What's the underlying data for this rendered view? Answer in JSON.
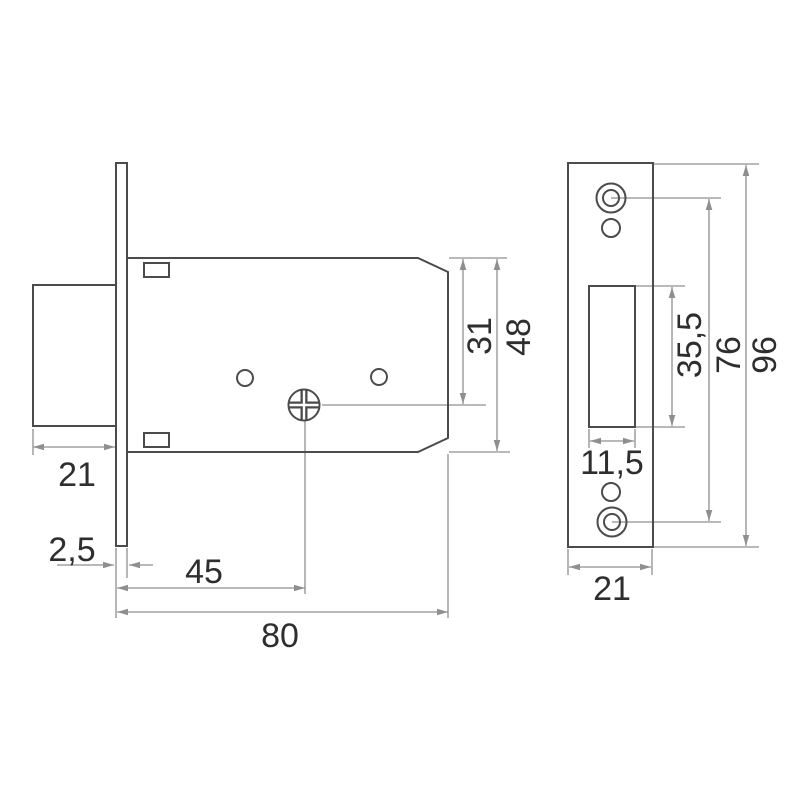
{
  "colors": {
    "outline": "#4b4b4b",
    "dimension": "#8f8f8f",
    "text": "#2e2e2e",
    "background": "#ffffff"
  },
  "drawing_type": "mortise-lock-technical-drawing",
  "views": {
    "lock_body": {
      "label": "lock body front view",
      "dims": {
        "bolt_width": "21",
        "faceplate_thickness": "2,5",
        "backset": "45",
        "case_depth": "80",
        "top_to_spindle": "31",
        "case_height": "48"
      }
    },
    "strike_plate": {
      "label": "faceplate view",
      "dims": {
        "cutout_height": "35,5",
        "screw_hole_spacing": "76",
        "plate_height": "96",
        "cutout_width": "11,5",
        "plate_width": "21"
      }
    }
  }
}
